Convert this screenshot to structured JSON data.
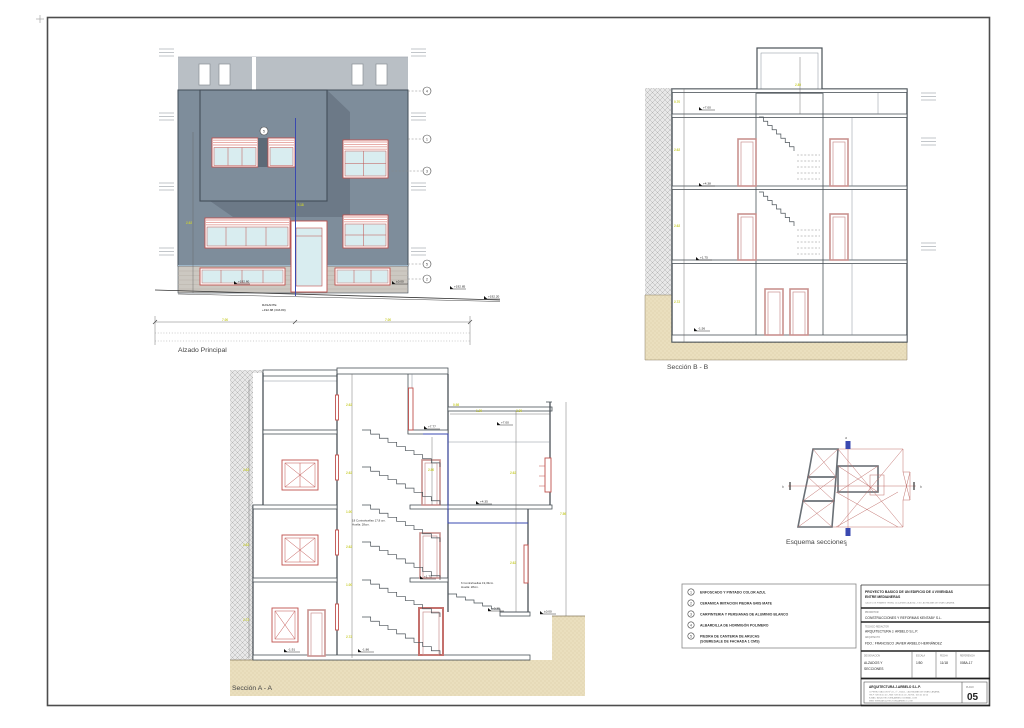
{
  "palette": {
    "facade_slate": "#7e8d9b",
    "shadow": "#6c7987",
    "neighbor": "#b9bfc5",
    "stone_band": "#ccc8c1",
    "glass": "#d9edf0",
    "frame_red": "#c0504d",
    "door_salmon": "#c9928f",
    "ground_tan": "#eadfbe",
    "dim_yellow": "#c9ce35",
    "axis_blue": "#3a49b0"
  },
  "alzado": {
    "caption": "Alzado Principal",
    "rasante_label": "RASANTE",
    "rasante_value": "+192.88 (343.80)",
    "level_left": "+192.60",
    "level_door": "±0.00",
    "level_right": "+192.85",
    "level_end": "+192.20",
    "dim_left": "7.00",
    "dim_right": "7.00",
    "dim_axis": "5.18",
    "dim_height": "2.62",
    "callout_volume": "5",
    "callout_top": "4",
    "callout_1": "1",
    "callout_3": "3",
    "callout_5": "5",
    "callout_2": "2"
  },
  "seccion_b": {
    "caption": "Sección B - B",
    "level_1": "+7.00",
    "level_2": "+4.38",
    "level_3": "+1.75",
    "level_4": "-1.56",
    "dim_1": "0.70",
    "dim_2": "2.62",
    "dim_3": "2.62",
    "dim_4": "2.72",
    "dim_tower": "2.80"
  },
  "seccion_a": {
    "caption": "Sección A - A",
    "note1_line1": "18 Contrahuellas  17,8 cm.",
    "note1_line2": "Huella: 28cm.",
    "note2_line1": "6 Contrahuellas  19,33cm.",
    "note2_line2": "Huella: 28cm.",
    "lvl_top_mid": "+7.77",
    "lvl_top_right": "+7.00",
    "lvl_mid_right": "+4.35",
    "lvl_mid": "+1.75",
    "lvl_low_right": "+0.35",
    "lvl_ground_right": "±0.00",
    "lvl_bottom_left": "-1.91",
    "lvl_bottom_mid": "-1.86",
    "dims": [
      "2.62",
      "2.62",
      "2.72",
      "2.62",
      "2.62",
      "1.00",
      "2.62",
      "1.00",
      "2.72",
      "0.98",
      "2.62",
      "2.62",
      "1.20",
      "2.30",
      "2.80",
      "7.56"
    ]
  },
  "esquema": {
    "caption": "Esquema secciones",
    "marker_top": "a",
    "marker_bottom": "a",
    "marker_left": "b",
    "marker_right": "b"
  },
  "legend": {
    "item1_num": "1",
    "item1_text": "ENFOSCADO Y PINTADO COLOR AZUL",
    "item2_num": "2",
    "item2_text": "CERAMICA IMITACION PIEDRA GRIS MATE",
    "item3_num": "3",
    "item3_text": "CARPINTERIA Y PERSIANAS DE ALUMINIO BLANCO",
    "item4_num": "4",
    "item4_text": "ALBARDILLA  DE HORMIGÓN POLIMERO",
    "item5_num": "5",
    "item5_text": "PIEDRA DE CANTERIA DE ARUCAS",
    "item5_text2": "(SOBRESALE DE FACHADA 1 CMS)"
  },
  "titleblock": {
    "project_line1": "PROYECTO BASICO DE UN EDIFICIO DE 4 VIVIENDAS",
    "project_line2": "ENTRE MEDIANERAS",
    "project_address": "CALLE LOS PINARES TRSRA, 12 (LA MINILLA ALTA) - T.M. LAS PALMAS DE GRAN CANARIA",
    "promotor_label": "PROMOTOR",
    "promotor": "CONSTRUCCIONES Y REFORMAS KENTABY S.L.",
    "tecnico_label": "TECNICO REDACTOR",
    "tecnico": "ARQUITECTURA J. ARBELO S.L.P.",
    "arquitecto_label": "ARQUITECTO",
    "arquitecto": "FDO.: FRANCISCO JAVIER ARBELO HERNÁNDEZ",
    "designacion_label": "DESIGNACION",
    "designacion_line1": "ALZADOS Y",
    "designacion_line2": "SECCIONES",
    "escala_label": "ESCALA",
    "escala": "1/50",
    "fecha_label": "FECHA",
    "fecha": "11/18",
    "referencia_label": "REFERENCIA",
    "referencia": "008A-17",
    "firma": "ARQUITECTURA J.ARBELO S.L.P.",
    "firma_line1": "C/ PEREZ GALDOS Nº 24 - 1º - 35002 - LAS PALMAS DE GRAN CANARIA",
    "firma_line2": "TELF: 928 36 41 00 - FAX: 928 36 41 00 - MOVIL: 616 41 00 00",
    "firma_line3": "E-MAIL: ARQUITECTURAJARBELO@GMAIL.COM",
    "firma_line4": "WEB: WWW.ARQUITECTURAJARBELO.COM",
    "plano_label": "PLANO",
    "plano_num": "05"
  }
}
